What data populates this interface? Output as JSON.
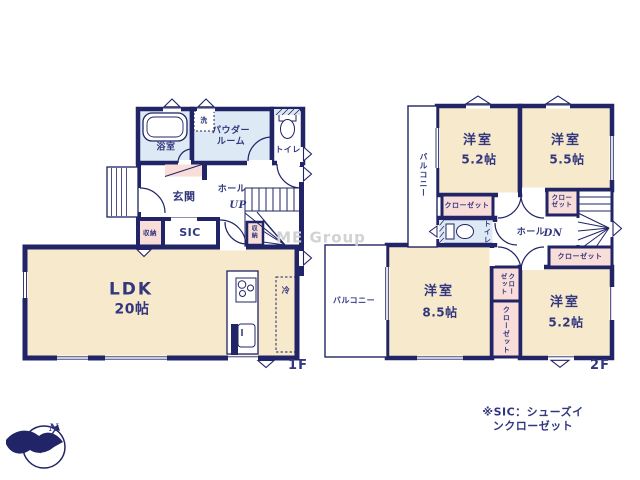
{
  "colors": {
    "wall": "#212466",
    "text": "#32377e",
    "room_cream": "#f7e9cc",
    "room_blue": "#dde9f4",
    "closet_pink": "#f9ddd8",
    "watermark_gray": "#d2d2d2"
  },
  "floor1": {
    "floor_label": "1F",
    "bath": "浴室",
    "washer": "洗",
    "powder_room": "パウダー\nルーム",
    "toilet": "トイレ",
    "entrance": "玄関",
    "hall": "ホール",
    "stairs_up": "UP",
    "storage_left": "収納",
    "storage_stairs": "収\n納",
    "sic": "SIC",
    "ldk_name": "LDK",
    "ldk_size": "20帖",
    "fridge": "冷"
  },
  "floor2": {
    "floor_label": "2F",
    "balcony_upper": "バルコニー",
    "balcony_lower": "バルコニー",
    "room_52a_name": "洋室",
    "room_52a_size": "5.2帖",
    "room_55_name": "洋室",
    "room_55_size": "5.5帖",
    "room_85_name": "洋室",
    "room_85_size": "8.5帖",
    "room_52b_name": "洋室",
    "room_52b_size": "5.2帖",
    "closet_a": "クローゼット",
    "closet_b": "クロー\nゼット",
    "closet_c": "クローゼット",
    "closet_d": "クロー\nゼット",
    "closet_e": "クローゼット",
    "toilet": "トイレ",
    "hall": "ホール",
    "stairs_dn": "DN"
  },
  "annotations": {
    "note": "※SIC：シューズインクローゼット",
    "watermark": "ME Group",
    "compass_north": "N"
  }
}
